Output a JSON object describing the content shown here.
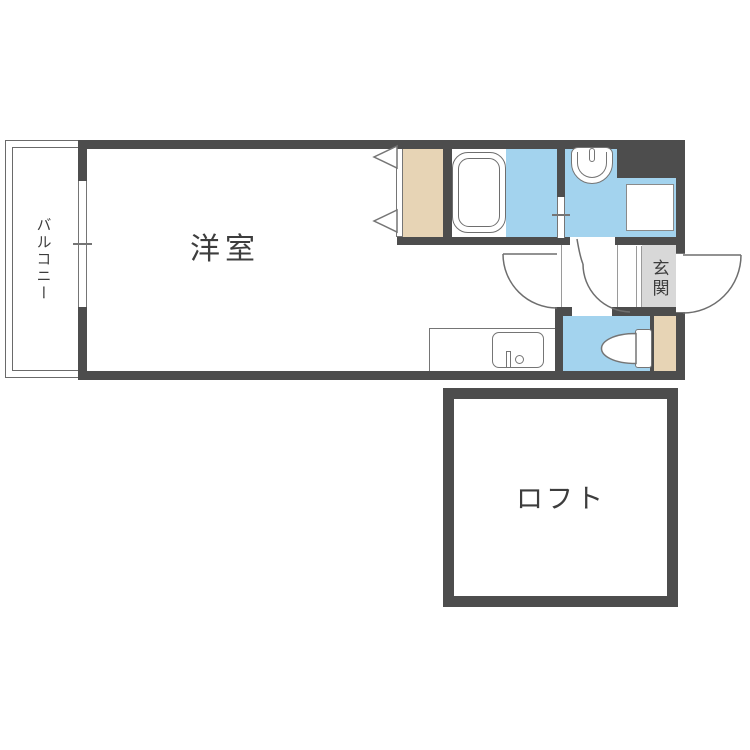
{
  "plan": {
    "type": "japanese-apartment-floor-plan",
    "rooms": {
      "western_room": {
        "label": "洋室"
      },
      "balcony": {
        "label": "バルコニー"
      },
      "entrance": {
        "label": "玄関"
      },
      "loft": {
        "label": "ロフト"
      }
    },
    "fixtures": [
      "bathtub",
      "washbasin",
      "washing-machine-space",
      "toilet",
      "kitchen-counter-sink",
      "folding-door-closet",
      "entry-side-closet",
      "window-balcony",
      "window-bath",
      "door-western-room",
      "door-washroom",
      "door-entrance"
    ],
    "colors": {
      "wall": "#4d4d4d",
      "water": "#a3d3ee",
      "wood": "#e7d4b5",
      "genkan": "#d8d8d8",
      "outline": "#757575",
      "text": "#3d3d3d",
      "paper": "#ffffff"
    }
  }
}
